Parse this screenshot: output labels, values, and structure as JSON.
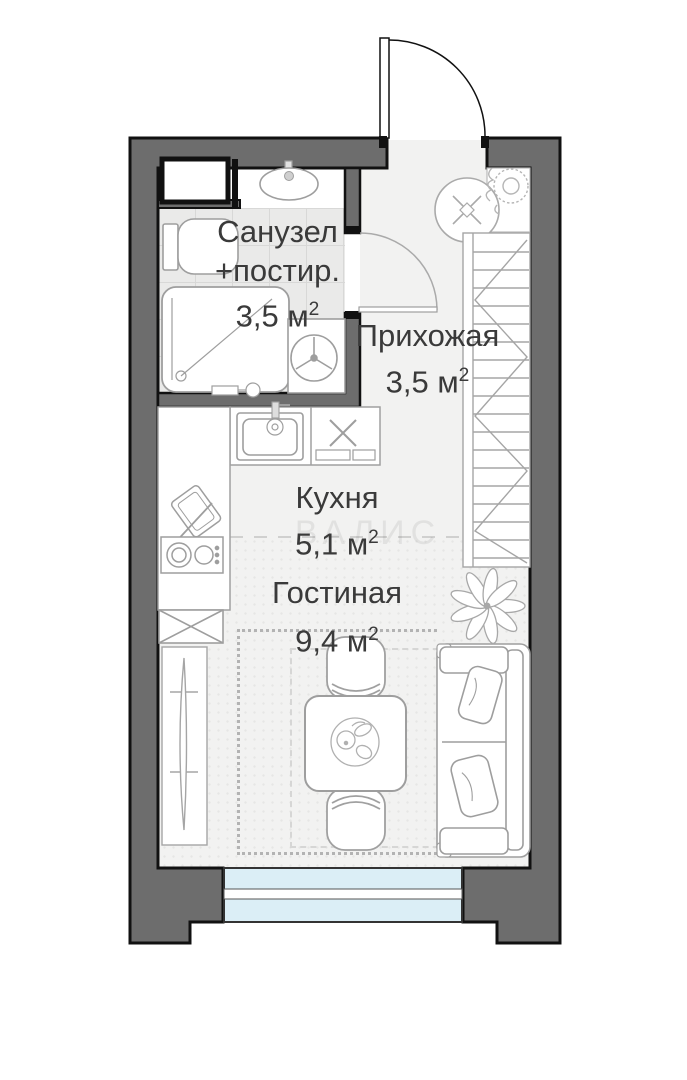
{
  "plan_type": "studio-apartment-floor-plan",
  "rooms": [
    {
      "id": "bathroom",
      "lines": [
        "Санузел",
        "+постир."
      ],
      "area_value": "3,5 м",
      "area_sup": "2"
    },
    {
      "id": "hallway",
      "label": "Прихожая",
      "area_value": "3,5 м",
      "area_sup": "2"
    },
    {
      "id": "kitchen",
      "label": "Кухня",
      "area_value": "5,1 м",
      "area_sup": "2"
    },
    {
      "id": "living",
      "label": "Гостиная",
      "area_value": "9,4 м",
      "area_sup": "2"
    }
  ],
  "watermark": "ВАЛИС",
  "colors": {
    "wall_fill": "#6d6d6d",
    "wall_outline": "#111111",
    "floor": "#f2f2f1",
    "bathroom_tile": "#eaeae9",
    "window_glass": "#dbeef6",
    "furniture_stroke": "#9e9e9e",
    "label_text": "#3a3a3a"
  },
  "icons": {
    "entrance_door": "quarter-arc door swing",
    "bathroom_door": "quarter-arc door swing",
    "bathroom_sink": "oval basin with tap",
    "toilet": "tank and bowl",
    "shower": "rounded tray with diagonal and drain",
    "washing_machine": "drum circle with three spokes",
    "water_heater": "circle with x-cross",
    "corner_plant": "gear-like potted plant",
    "wardrobe": "closet with shelf hatching",
    "kitchen_sink": "square basin with tap",
    "counter_x": "x appliance marker",
    "hob": "two-burner cooktop",
    "cutting_board": "board with knife",
    "appliance_box": "rectangle with diagonal cross",
    "tv_panel": "slim screen on cabinet",
    "dining_table": "square table with fruit bowl",
    "chair": "chair with curved backrest",
    "sofa": "two-seat sofa with pillows",
    "lotus_plant": "flower top view",
    "window": "double glazing with sill"
  }
}
